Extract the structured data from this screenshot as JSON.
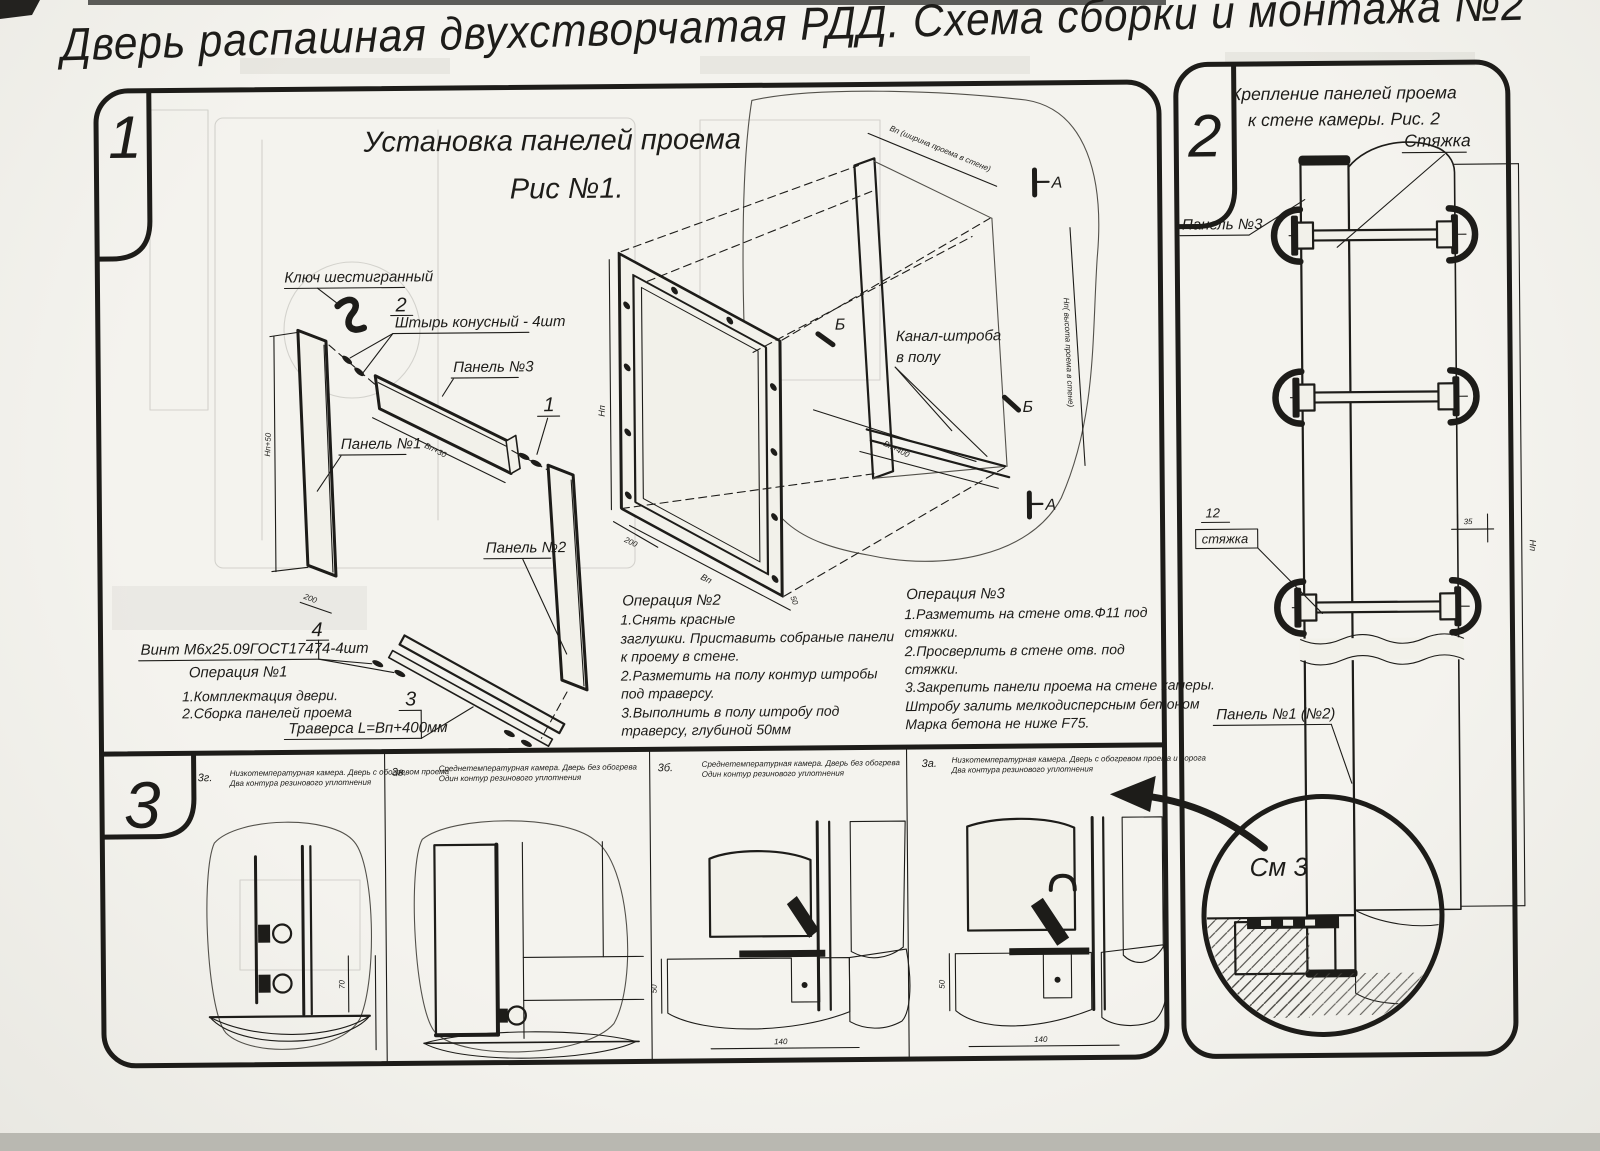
{
  "title": "Дверь распашная двухстворчатая РДД.  Схема сборки и монтажа №2",
  "section1": {
    "num": "1",
    "fig_title1": "Установка панелей проема",
    "fig_title2": "Рис №1.",
    "labels": {
      "hex_key": "Ключ шестигранный",
      "pin": "Штырь конусный - 4шт",
      "panel3": "Панель №3",
      "panel1": "Панель №1",
      "panel2": "Панель №2",
      "screw": "Винт М6х25.09ГОСТ17474-4шт",
      "traverse": "Траверса  L=Вп+400мм",
      "channel1": "Канал-штроба",
      "channel2": "в полу"
    },
    "callouts": {
      "c1": "1",
      "c2": "2",
      "c3": "3",
      "c4": "4"
    },
    "markers": {
      "a": "А",
      "b": "Б"
    },
    "dims": {
      "np50": "Нп+50",
      "d200a": "200",
      "vp30": "Вп+30",
      "np_frame": "Нп",
      "d200b": "200",
      "vp": "Вп",
      "d50": "50",
      "vp400": "Вп+400",
      "top": "Вп (ширина проема в стене)",
      "right": "Нп( высота проема в стене)"
    },
    "op1": {
      "title": "Операция №1",
      "lines": [
        "1.Комплектация двери.",
        "2.Сборка панелей проема"
      ]
    },
    "op2": {
      "title": "Операция №2",
      "lines": [
        "1.Снять красные",
        "заглушки. Приставить собраные панели",
        "к проему в стене.",
        "2.Разметить на полу контур штробы",
        "под траверсу.",
        "3.Выполнить в полу штробу под",
        "траверсу, глубиной 50мм"
      ]
    },
    "op3": {
      "title": "Операция №3",
      "lines": [
        "1.Разметить на стене отв.Ф11 под",
        "стяжки.",
        "2.Просверлить в стене отв.  под",
        "стяжки.",
        "3.Закрепить панели проема на стене камеры.",
        "Штробу залить мелкодисперсным бетоном",
        "Марка бетона не ниже  F75."
      ]
    }
  },
  "section2": {
    "num": "2",
    "header1": "Крепление панелей проема",
    "header2": "к стене камеры. Рис. 2",
    "labels": {
      "tie": "Стяжка",
      "panel3": "Панель №3",
      "n12": "12",
      "tie2": "стяжка",
      "panel12": "Панель №1 (№2)",
      "see3": "См 3"
    },
    "dims": {
      "d35": "35",
      "np": "Нп"
    }
  },
  "section3": {
    "num": "3",
    "panels": [
      {
        "id": "3г.",
        "cap1": "Низкотемпературная камера. Дверь с обогревом проема",
        "cap2": "Два контура резинового уплотнения",
        "dim_v": "70"
      },
      {
        "id": "3в.",
        "cap1": "Среднетемпературная камера. Дверь без обогрева",
        "cap2": "Один контур резинового уплотнения"
      },
      {
        "id": "3б.",
        "cap1": "Среднетемпературная камера. Дверь без обогрева",
        "cap2": "Один контур резинового уплотнения",
        "dim_v": "50",
        "dim_h": "140"
      },
      {
        "id": "3а.",
        "cap1": "Низкотемпературная камера. Дверь с обогревом проема и порога",
        "cap2": "Два контура резинового уплотнения",
        "dim_v": "50",
        "dim_h": "140"
      }
    ]
  }
}
